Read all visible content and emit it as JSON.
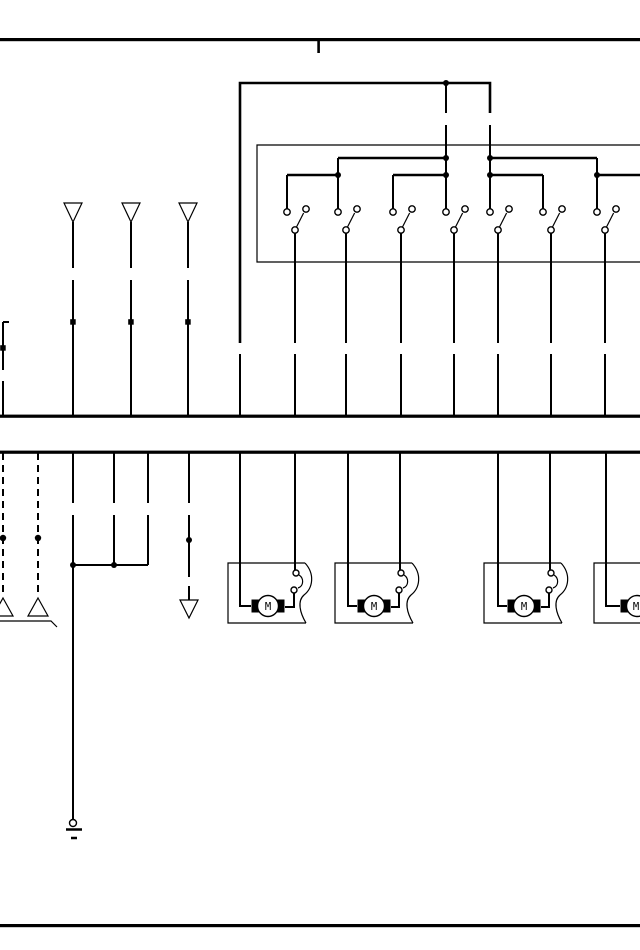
{
  "page": {
    "background_color": "#ffffff",
    "ink_color": "#000000"
  },
  "diagram": {
    "type": "wiring-schematic",
    "switch_count": 7,
    "motor_unit_count": 4,
    "motor_units": [
      {
        "label": "M"
      },
      {
        "label": "M"
      },
      {
        "label": "M"
      },
      {
        "label": "M"
      }
    ],
    "top_triangle_connector_count": 3,
    "bottom_up_triangle_count": 2,
    "bottom_down_triangle_count": 1
  }
}
